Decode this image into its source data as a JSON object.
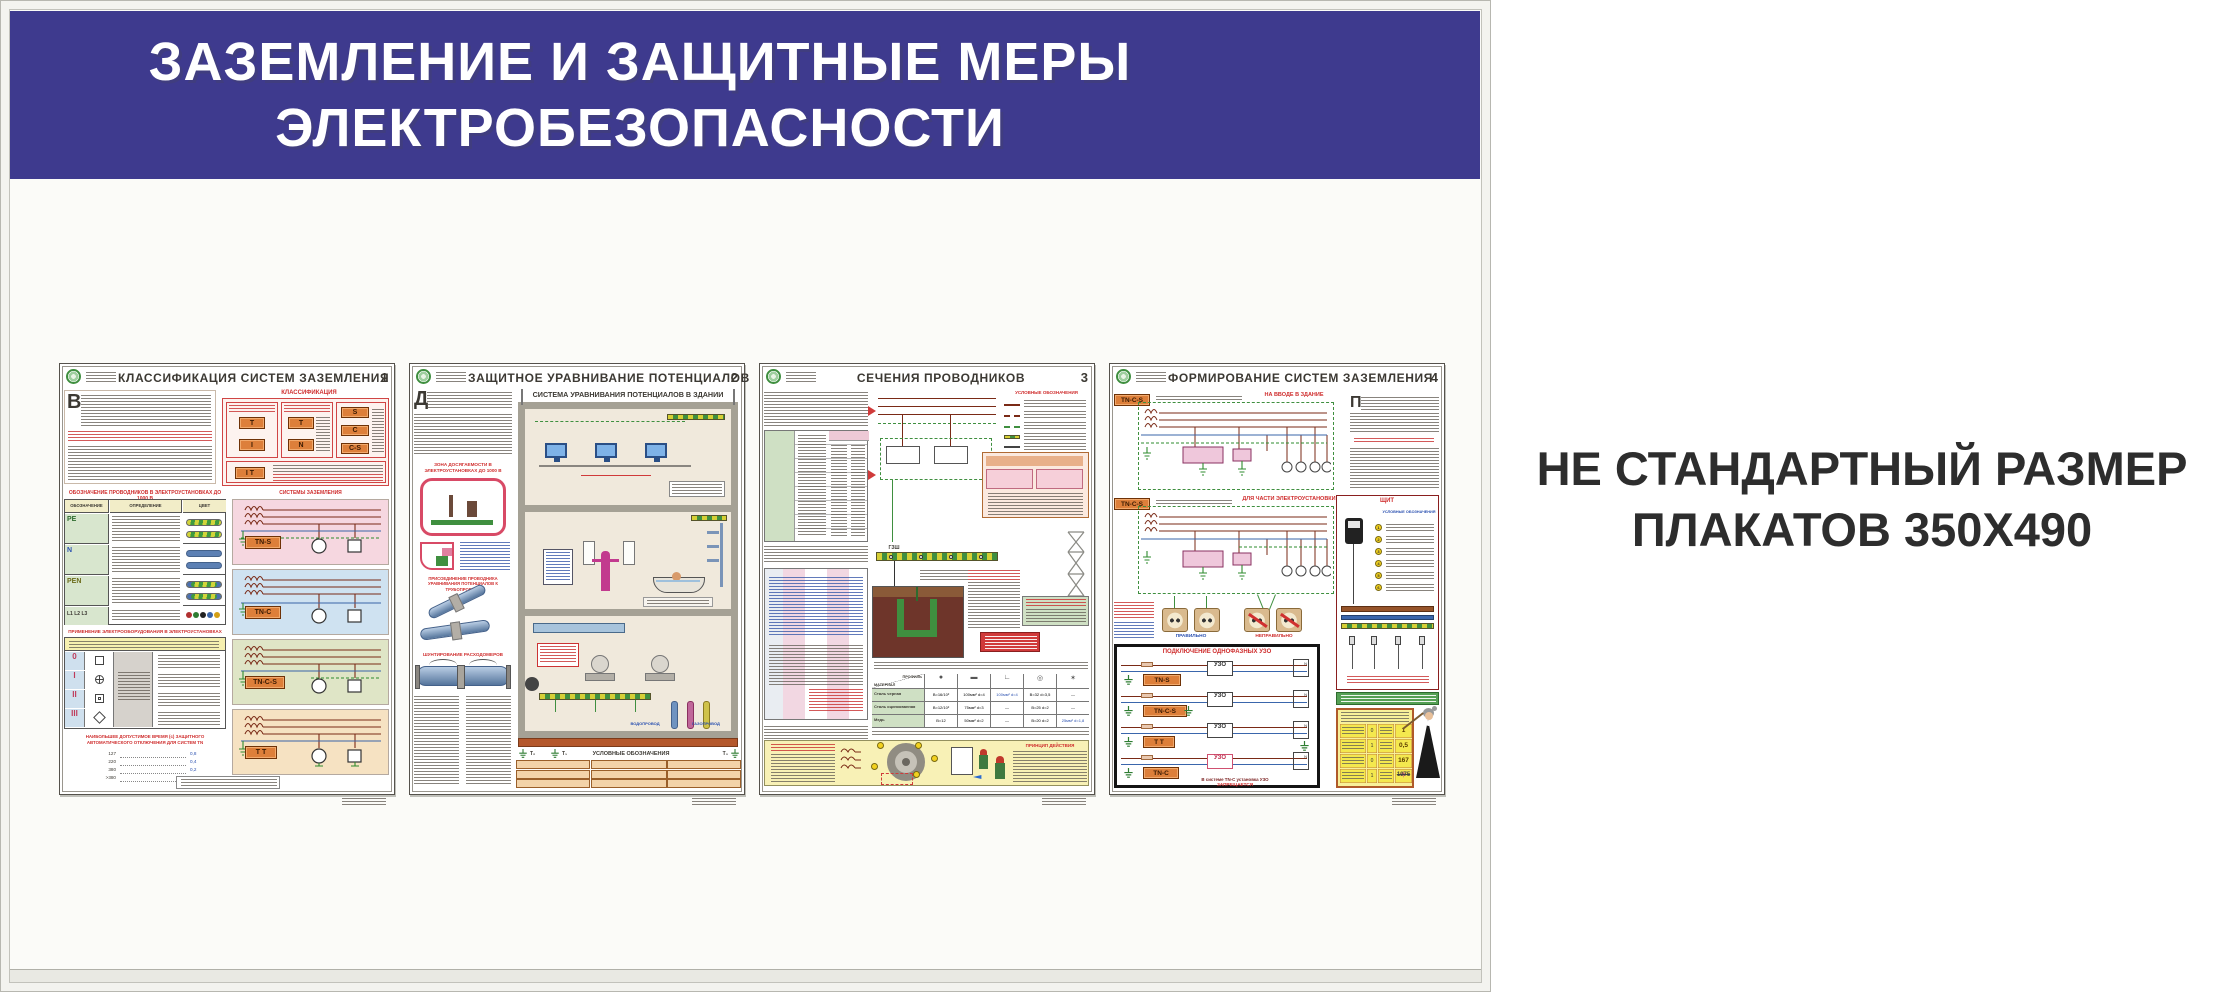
{
  "board": {
    "header_bg": "#3e3a8e",
    "title_line1": "ЗАЗЕМЛЕНИЕ И ЗАЩИТНЫЕ МЕРЫ",
    "title_line2": "ЭЛЕКТРОБЕЗОПАСНОСТИ"
  },
  "side_note": {
    "line1": "НЕ СТАНДАРТНЫЙ РАЗМЕР",
    "line2": "ПЛАКАТОВ 350X490"
  },
  "posters": [
    {
      "number": "1",
      "title": "КЛАССИФИКАЦИЯ СИСТЕМ ЗАЗЕМЛЕНИЯ",
      "classification": {
        "title": "КЛАССИФИКАЦИЯ",
        "chips_col1": [
          "T",
          "I"
        ],
        "chips_col2": [
          "T",
          "N"
        ],
        "chips_col3": [
          "S",
          "C",
          "C-S"
        ],
        "chip_bottom": "I T"
      },
      "conductors": {
        "title": "ОБОЗНАЧЕНИЕ ПРОВОДНИКОВ В ЭЛЕКТРОУСТАНОВКАХ ДО 1000 В",
        "columns": [
          "ОБОЗНАЧЕНИЕ",
          "ОПРЕДЕЛЕНИЕ",
          "ЦВЕТ"
        ],
        "rows": [
          "PE",
          "N",
          "PEN",
          "L1 L2 L3"
        ]
      },
      "equipment": {
        "title": "ПРИМЕНЕНИЕ ЭЛЕКТРООБОРУДОВАНИЯ В ЭЛЕКТРОУСТАНОВКАХ",
        "classes": [
          "0",
          "I",
          "II",
          "III"
        ]
      },
      "systems": {
        "title": "СИСТЕМЫ ЗАЗЕМЛЕНИЯ",
        "items": [
          {
            "label": "TN-S",
            "bg": "#f6d7e0"
          },
          {
            "label": "TN-C",
            "bg": "#cfe2f1"
          },
          {
            "label": "TN-C-S",
            "bg": "#dfe5c6"
          },
          {
            "label": "T T",
            "bg": "#f6e2c2"
          }
        ]
      },
      "trip_time": {
        "title": "НАИБОЛЬШЕЕ ДОПУСТИМОЕ ВРЕМЯ (с) ЗАЩИТНОГО АВТОМАТИЧЕСКОГО ОТКЛЮЧЕНИЯ ДЛЯ СИСТЕМ TN",
        "rows": [
          {
            "u": "127",
            "t": "0,8"
          },
          {
            "u": "220",
            "t": "0,4"
          },
          {
            "u": "380",
            "t": "0,2"
          },
          {
            "u": ">380",
            "t": "0,1"
          }
        ]
      }
    },
    {
      "number": "2",
      "title": "ЗАЩИТНОЕ УРАВНИВАНИЕ ПОТЕНЦИАЛОВ",
      "main_title": "СИСТЕМА УРАВНИВАНИЯ ПОТЕНЦИАЛОВ В ЗДАНИИ",
      "reach_zone_title": "ЗОНА ДОСЯГАЕМОСТИ В ЭЛЕКТРОУСТАНОВКАХ ДО 1000 В",
      "attach_title": "ПРИСОЕДИНЕНИЕ ПРОВОДНИКА УРАВНИВАНИЯ ПОТЕНЦИАЛОВ К ТРУБОПРОВОДУ",
      "shunt_title": "ШУНТИРОВАНИЕ РАСХОДОМЕРОВ",
      "legend_title": "УСЛОВНЫЕ ОБОЗНАЧЕНИЯ",
      "ground_labels": [
        "Т₂",
        "Т₁",
        "Т₃"
      ],
      "pipe_labels": {
        "water": "ВОДОПРОВОД",
        "gas": "ГАЗОПРОВОД"
      }
    },
    {
      "number": "3",
      "title": "СЕЧЕНИЯ ПРОВОДНИКОВ",
      "legend_title": "УСЛОВНЫЕ ОБОЗНАЧЕНИЯ",
      "busbar_label": "ГЗШ",
      "materials": {
        "corner_top": "ПРОФИЛЬ",
        "corner_bottom": "МАТЕРИАЛ",
        "rows": [
          {
            "name": "Сталь черная",
            "values": [
              "В=16/10²",
              "100мм² d=4",
              "100мм² d=4",
              "В=32 d=3,5",
              "—"
            ]
          },
          {
            "name": "Сталь оцинкованная",
            "values": [
              "В=12/10²",
              "75мм² d=3",
              "—",
              "В=25 d=2",
              "—"
            ]
          },
          {
            "name": "Медь",
            "values": [
              "В=12",
              "50мм² d=2",
              "—",
              "В=20 d=2",
              "25мм² d=1,8"
            ]
          }
        ]
      },
      "principle_title": "ПРИНЦИП ДЕЙСТВИЯ"
    },
    {
      "number": "4",
      "title": "ФОРМИРОВАНИЕ СИСТЕМ ЗАЗЕМЛЕНИЯ",
      "section1": {
        "chip": "TN-C-S",
        "label": "НА ВВОДЕ В ЗДАНИЕ"
      },
      "section2": {
        "chip": "TN-C-S",
        "label": "ДЛЯ ЧАСТИ ЭЛЕКТРОУСТАНОВКИ"
      },
      "sockets": {
        "ok": "ПРАВИЛЬНО",
        "bad": "НЕПРАВИЛЬНО"
      },
      "uzo": {
        "title": "ПОДКЛЮЧЕНИЕ ОДНОФАЗНЫХ УЗО",
        "device": "УЗО",
        "n_label": "N",
        "rows": [
          "TN-S",
          "TN-C-S",
          "T T",
          "TN-C"
        ],
        "note1": "В системе TN-C установка УЗО",
        "note2": "ЗАПРЕЩАЕТСЯ"
      },
      "shield": {
        "title": "ЩИТ",
        "legend_title": "УСЛОВНЫЕ ОБОЗНАЧЕНИЯ",
        "legend_nums": [
          "1",
          "2",
          "3",
          "4",
          "5",
          "6"
        ]
      },
      "table": {
        "mid": [
          "0",
          "1",
          "0",
          "1"
        ],
        "values": [
          "1",
          "0,5",
          "167",
          "1075"
        ]
      }
    }
  ]
}
